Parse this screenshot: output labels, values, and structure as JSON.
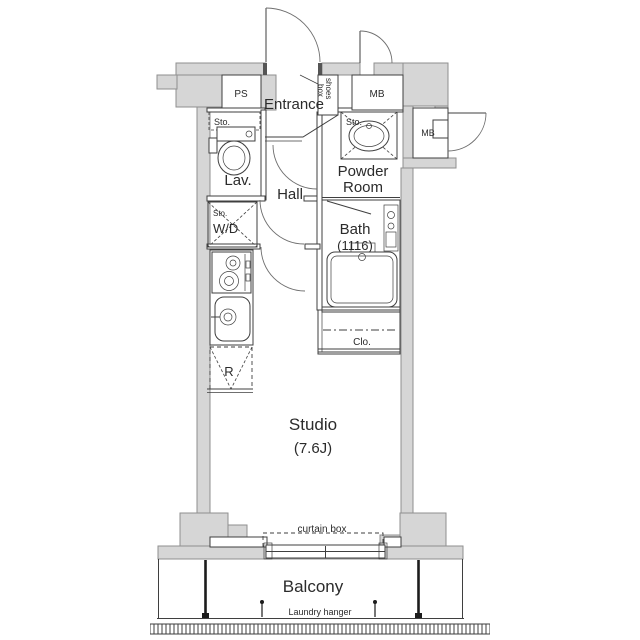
{
  "labels": {
    "ps": "PS",
    "entrance": "Entrance",
    "shoes_box_line1": "shoes",
    "shoes_box_line2": "box",
    "mb_top": "MB",
    "mb_side": "MB",
    "lav_storage": "Sto.",
    "lav": "Lav.",
    "powder_storage": "Sto.",
    "powder_line1": "Powder",
    "powder_line2": "Room",
    "hall": "Hall",
    "wd_storage": "Sto.",
    "wd": "W/D",
    "bath": "Bath",
    "bath_size": "(1116)",
    "closet": "Clo.",
    "refrigerator": "R",
    "studio": "Studio",
    "studio_size": "(7.6J)",
    "curtain_box": "curtain box",
    "balcony": "Balcony",
    "laundry_hanger": "Laundry hanger"
  },
  "colors": {
    "wall_fill": "#d6d6d6",
    "wall_edge": "#8f8f8f",
    "line": "#3f3f3f",
    "text": "#2b2b2b",
    "background": "#ffffff"
  }
}
